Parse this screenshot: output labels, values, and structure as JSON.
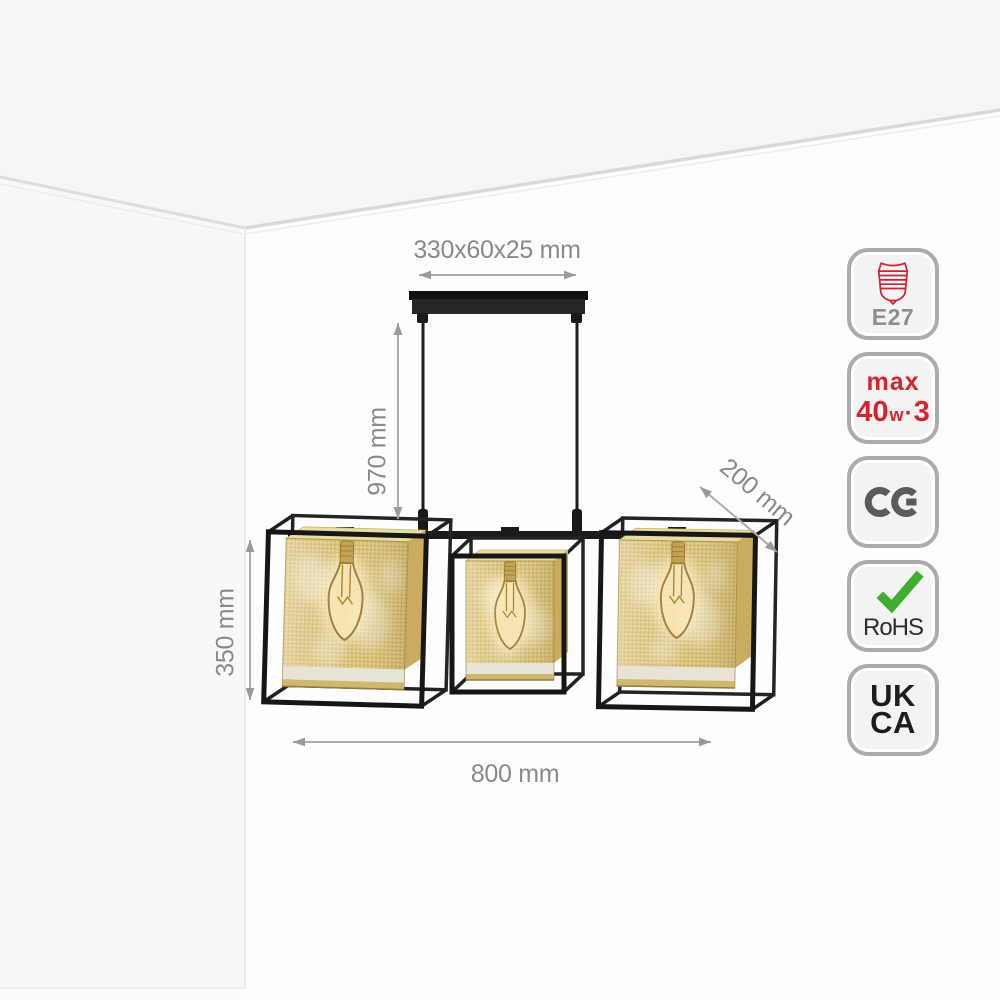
{
  "dimensions": {
    "canopy": "330x60x25 mm",
    "drop": "970 mm",
    "depth": "200 mm",
    "shade_height": "350 mm",
    "width": "800 mm"
  },
  "badges": {
    "e27": {
      "label": "E27"
    },
    "max_wattage": {
      "prefix": "max",
      "value": "40",
      "unit": "w",
      "separator": "·",
      "count": "3"
    },
    "ce": {
      "label": "CE"
    },
    "rohs": {
      "label": "RoHS"
    },
    "ukca": {
      "line1": "UK",
      "line2": "CA"
    }
  },
  "colors": {
    "frame_black": "#1b1b1b",
    "shade_gold": "#d9c178",
    "shade_gold_light": "#e9dda6",
    "shade_gold_dark": "#c9ac5f",
    "dimension_gray": "#8a8a8a",
    "arrow_gray": "#9a9a9a",
    "badge_border": "#a9abae",
    "badge_bg": "#f3f3f4",
    "accent_red": "#d5232f",
    "check_green": "#3fae2e",
    "ce_gray": "#5a5b5d",
    "mark_black": "#1d1d1b",
    "wall_gray": "#f7f8f7",
    "ceiling_gray": "#f5f6f5"
  }
}
